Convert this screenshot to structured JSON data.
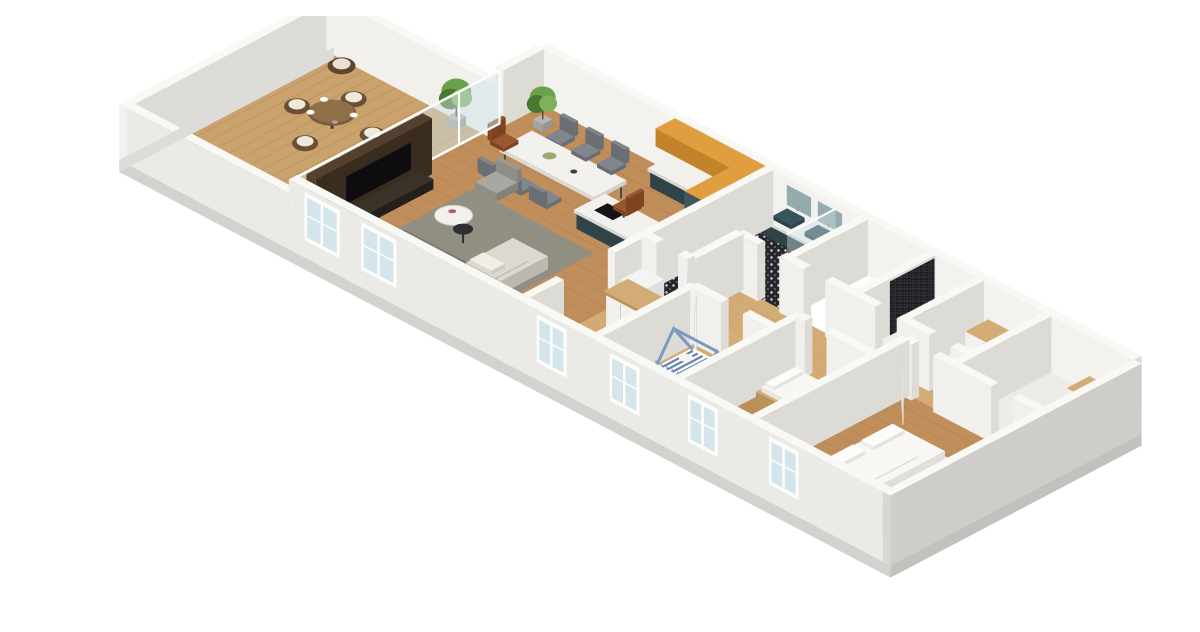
{
  "scene": {
    "title": "3D isometric floor plan rendering of an apartment",
    "rooms": [
      {
        "id": "terrace",
        "name": "Terrace with outdoor dining set and hedge planter"
      },
      {
        "id": "living-room",
        "name": "Living room with TV media wall and corner sofa"
      },
      {
        "id": "dining-area",
        "name": "Dining area with marble table and chairs"
      },
      {
        "id": "kitchen",
        "name": "Kitchen with teal island and orange wall cabinets"
      },
      {
        "id": "bathroom",
        "name": "Bathroom with double teal vanity and mosaic shower"
      },
      {
        "id": "wc-laundry",
        "name": "WC with patterned tile, toilet and washing machine"
      },
      {
        "id": "hallway",
        "name": "Hallway with wardrobe"
      },
      {
        "id": "nursery",
        "name": "Nursery with blue house-frame crib"
      },
      {
        "id": "bedroom-2",
        "name": "Bedroom with wooden bed"
      },
      {
        "id": "master-bedroom",
        "name": "Master bedroom with white double bed"
      },
      {
        "id": "bathroom-2",
        "name": "Second shower room with dark mosaic tile"
      },
      {
        "id": "storage",
        "name": "Storage room with wood-top dresser"
      },
      {
        "id": "far-room",
        "name": "End room with wood-top cabinet"
      }
    ],
    "furniture": [
      "outdoor-round-table",
      "wicker-chairs",
      "lounge-chair",
      "hedge",
      "potted-plants",
      "tv",
      "tv-console",
      "media-wall",
      "corner-sofa",
      "chaise-cushion",
      "rug",
      "coffee-table",
      "side-table",
      "armchair",
      "dining-table",
      "dining-chairs",
      "kitchen-counter",
      "upper-cabinets",
      "tall-cabinets",
      "island-sink",
      "vanity-double-sink",
      "mirror-cabinets",
      "shower-screen",
      "toilet",
      "washing-machine",
      "wardrobe",
      "shoe-box",
      "crib",
      "toy-box",
      "wood-bed",
      "double-bed",
      "dressers",
      "doors",
      "windows"
    ],
    "palette": {
      "wallTop": "#f8f8f5",
      "wallFront": "#f1f0ec",
      "wallSide": "#dcdbd6",
      "wallIn": "#f3f2ef",
      "wallOuter": "#eceae6",
      "slab": "#d3d2ce",
      "slabDark": "#c2c1bd",
      "deck": "#c9a26d",
      "deckLine": "#ad8350",
      "wood": "#bf8e5b",
      "woodLine": "#a3743f",
      "woodLight": "#d3ac75",
      "woodLightLine": "#bb9158",
      "walnut": "#53402f",
      "walnutDark": "#3a2c1f",
      "marble": "#f2f1ed",
      "marbleShade": "#dbd9d2",
      "teal": "#41585e",
      "tealDark": "#2f4348",
      "tealBright": "#2ea7a4",
      "orange": "#e09e3e",
      "orangeDark": "#c2832a",
      "sofa": "#6e6c66",
      "sofaDark": "#57554f",
      "cushion": "#dcd9d2",
      "rug": "#8e8e85",
      "leather": "#9a562f",
      "glass": "#cfe3ea",
      "frame": "#fdfdfc",
      "green1": "#49792f",
      "green2": "#6aa24a",
      "soil": "#74644a",
      "blue": "#9db4d6",
      "blueDark": "#7c99c2",
      "stripe": "#4c6f9e",
      "white": "#f8f7f4",
      "whiteShade": "#e8e6e1",
      "black": "#1a1a1d",
      "chair": "#80868b",
      "chairDark": "#686e73"
    }
  }
}
